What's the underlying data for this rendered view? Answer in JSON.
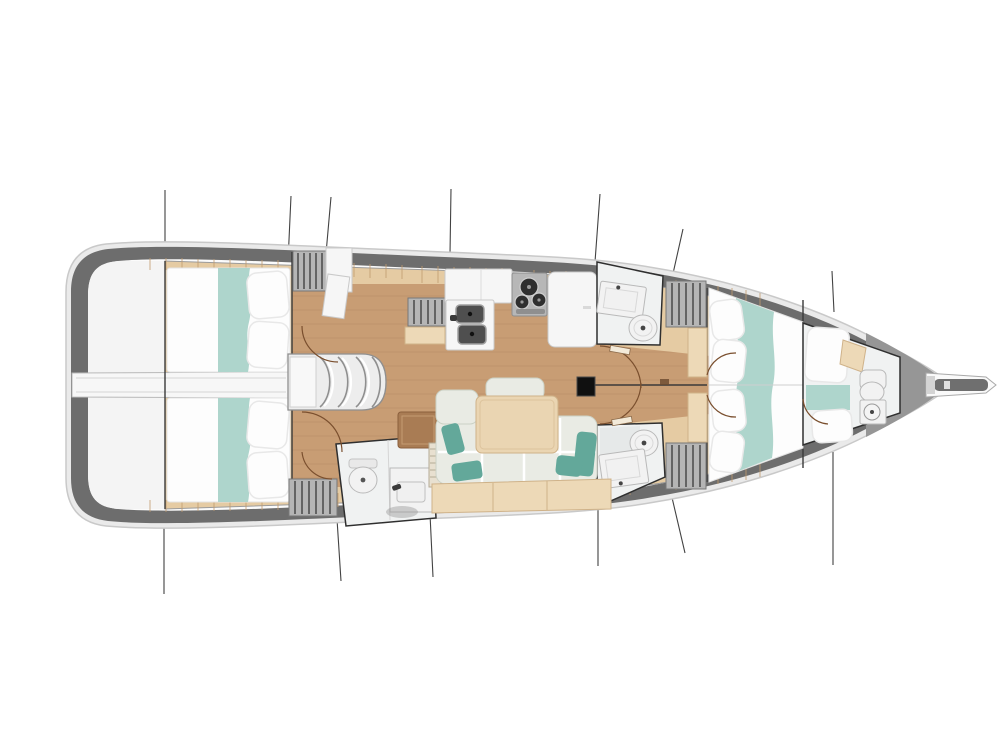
{
  "meta": {
    "title": "Sailing yacht interior layout — top-down floor plan",
    "drawing_type": "boat deck / accommodation plan",
    "orientation": "bow to the right, stern to the left"
  },
  "colors": {
    "hull_rim": "#eaeaea",
    "hull_stroke": "#c9c9c9",
    "hull_band": "#6d6d6d",
    "deck": "#fbfbfb",
    "bow_fill": "#969696",
    "interior_beige": "#e5cba3",
    "plank_tick": "#c09a6d",
    "floor_tan": "#c89d74",
    "floor_line": "#a87f58",
    "stern_white": "#f4f4f4",
    "engine_strip": "#f7f7f7",
    "wall": "#3a3a3a",
    "bed_white": "#fdfdfd",
    "bed_edge": "#e3e3e3",
    "blanket_teal": "#aed5cc",
    "pillow_stroke": "#e8e8e8",
    "hatch_fill": "#b5b5b5",
    "hatch_stripe": "#4a4a4a",
    "cabinet_white": "#f6f6f6",
    "cabinet_stroke": "#c9c9c9",
    "stove_gray": "#b7b7b7",
    "burner_dark": "#2f2f2f",
    "sink_dark": "#4f4f4f",
    "fixture_white": "#f2f2f2",
    "fixture_stroke": "#b9b9b9",
    "head_wall": "#2f2f2f",
    "settee": "#e9ebe4",
    "settee_stroke": "#ccd2c6",
    "cushion_teal": "#63a89a",
    "table_wood": "#ead5b2",
    "table_stroke": "#cfb289",
    "locker_beige": "#edd9b7",
    "side_table": "#a97c54",
    "door_arc": "#7a4f2e",
    "section_line": "#2e2e2e"
  },
  "elements": [
    {
      "name": "aft-cabin-port",
      "kind": "double berth with teal blanket and pillows"
    },
    {
      "name": "aft-cabin-starboard",
      "kind": "double berth with teal blanket and pillows"
    },
    {
      "name": "companionway-steps",
      "kind": "curved entry steps"
    },
    {
      "name": "engine-compartment-strip",
      "kind": "centerline white strip to transom"
    },
    {
      "name": "galley",
      "kind": "L-galley: double sink, 3-burner stove, counters"
    },
    {
      "name": "head-starboard-top",
      "kind": "toilet and washbasin"
    },
    {
      "name": "head-starboard-bottom",
      "kind": "toilet and washbasin"
    },
    {
      "name": "aft-head",
      "kind": "toilet, washbasin, shower"
    },
    {
      "name": "salon",
      "kind": "L-settee with teal cushions, wood table, side table, lockers"
    },
    {
      "name": "mast",
      "kind": "mast section on centerline"
    },
    {
      "name": "owner-cabin-bow",
      "kind": "large berth, pillows aft, teal runner"
    },
    {
      "name": "bow-compartment",
      "kind": "forepeak berth with toilet and basin"
    },
    {
      "name": "bowsprit",
      "kind": "anchor roller fitting"
    },
    {
      "name": "section-lines",
      "kind": "rig/section marker lines above and below hull"
    }
  ]
}
